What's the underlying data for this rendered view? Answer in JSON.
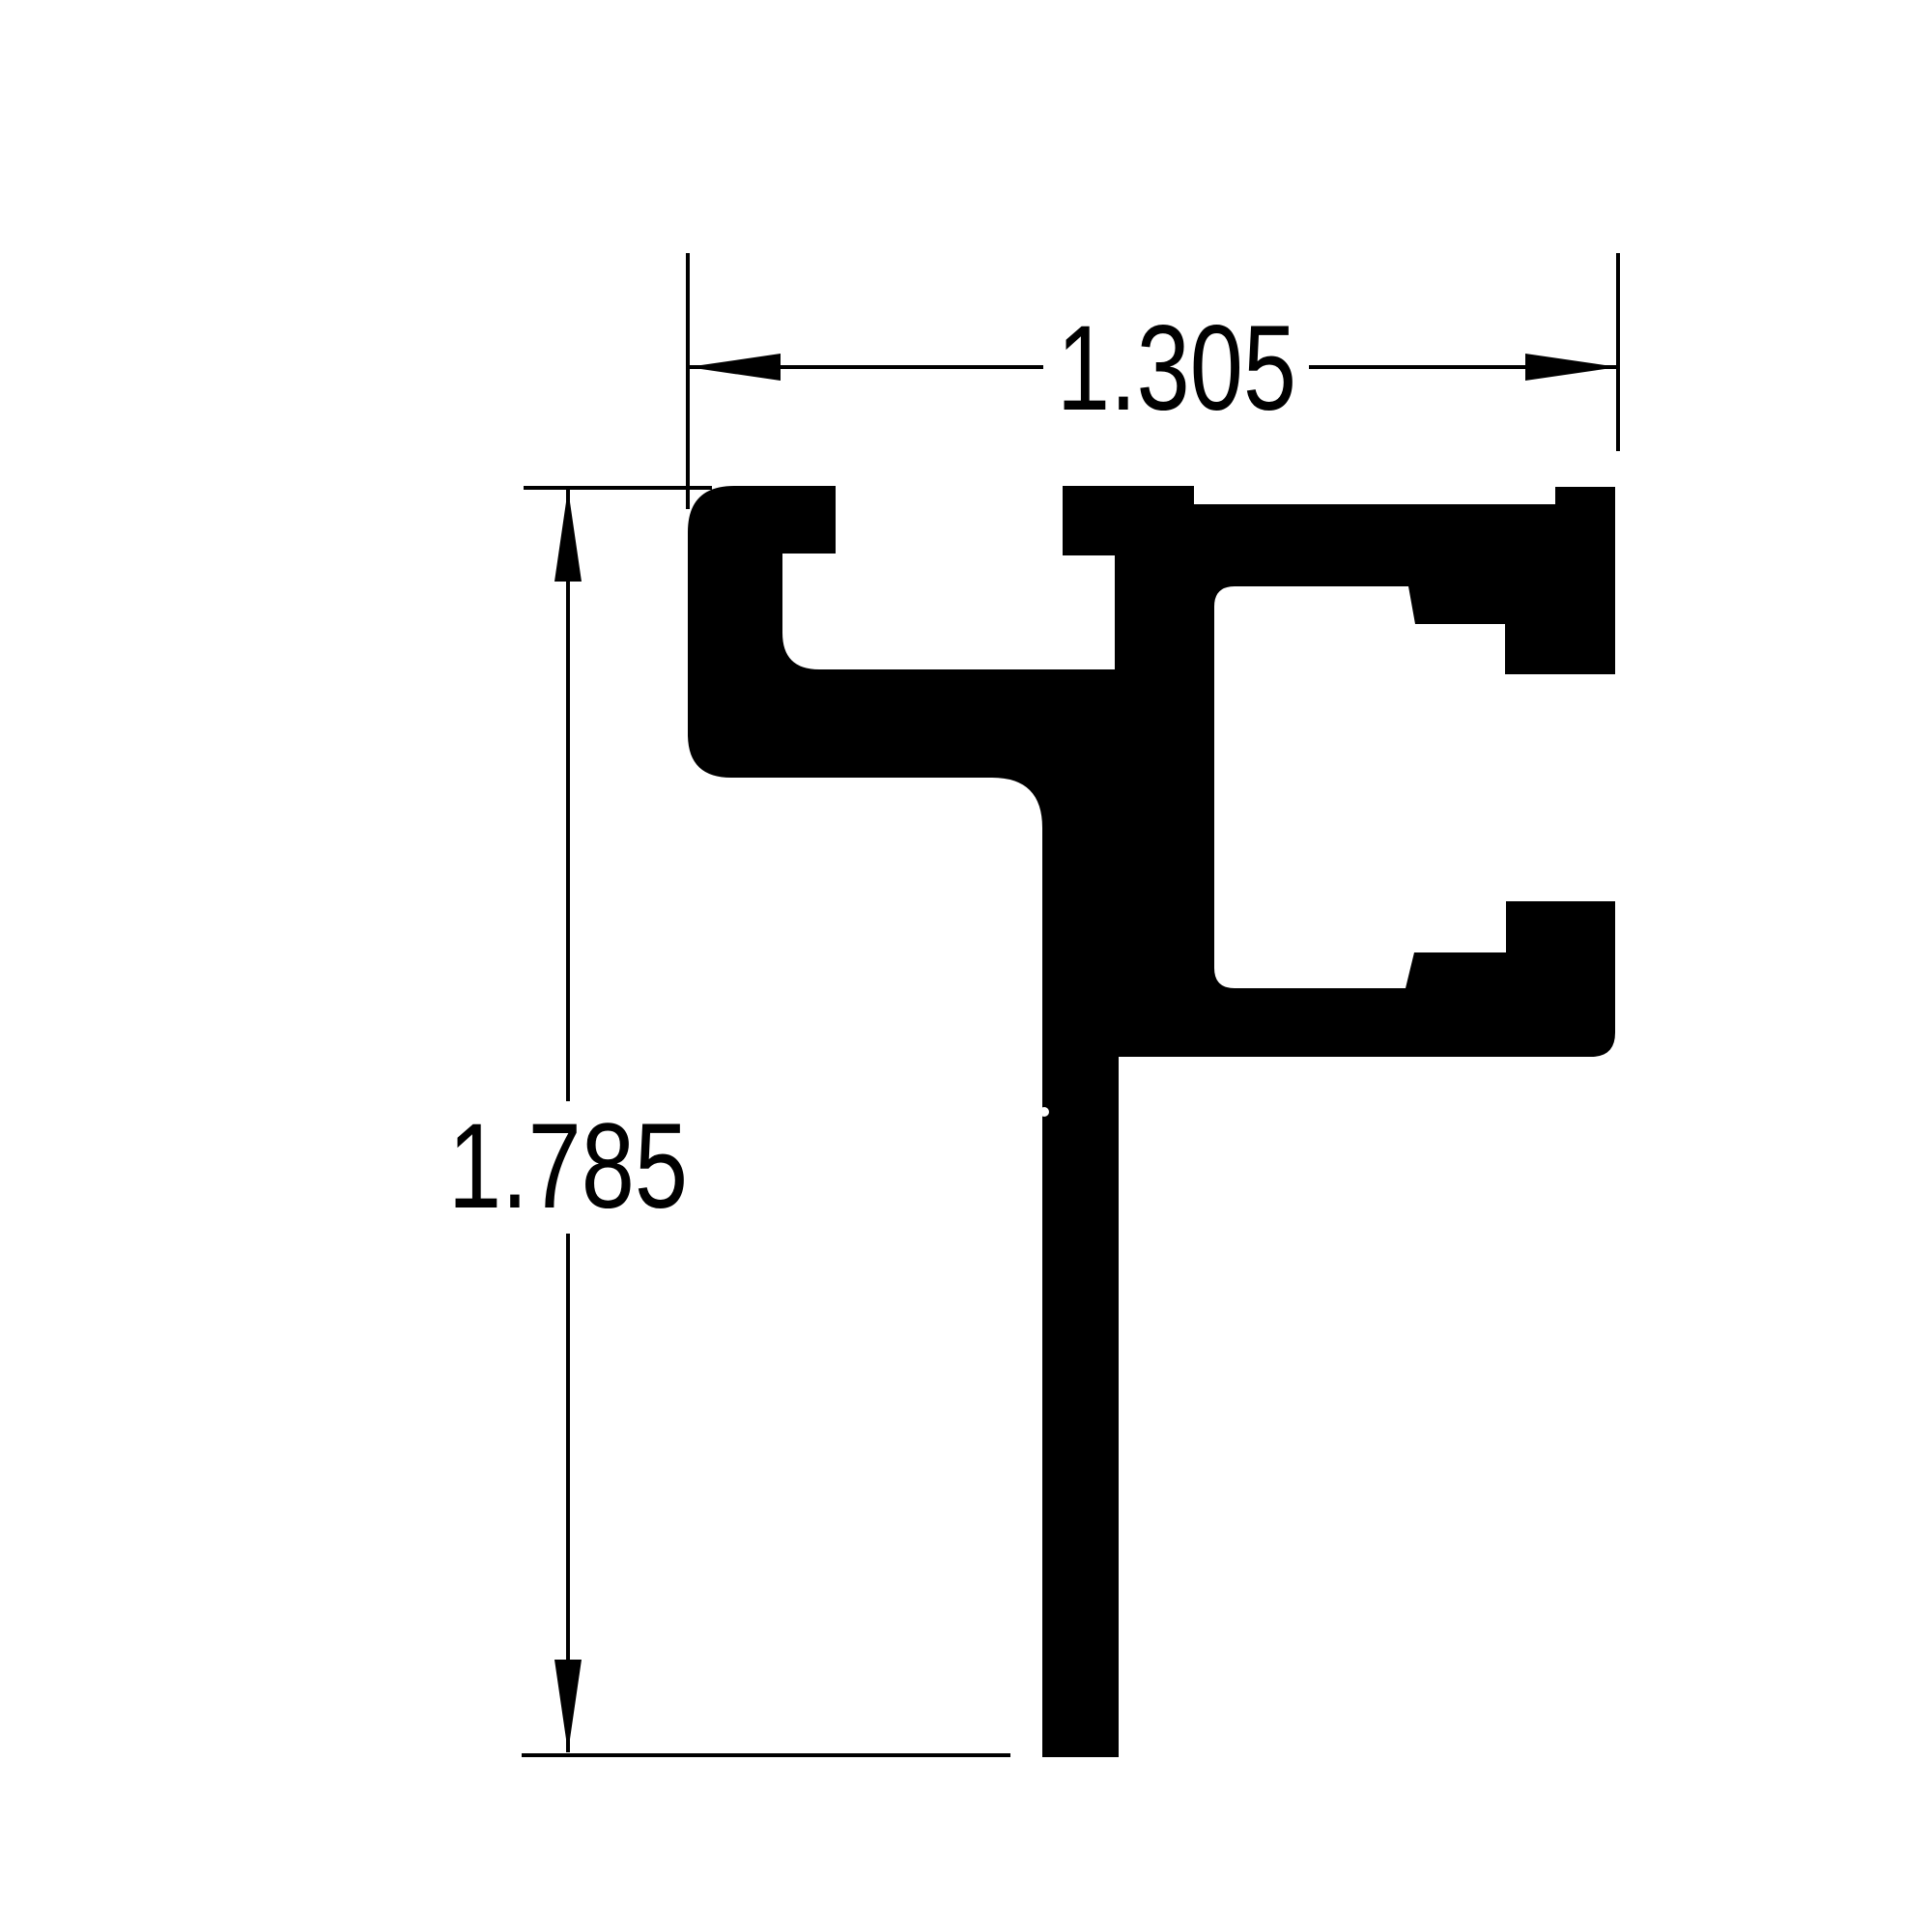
{
  "drawing": {
    "title": "Aluminum extrusion profile cross-section",
    "view": "2D section view with linear dimensions"
  },
  "dimensions": {
    "width": {
      "label": "1.305",
      "orientation": "horizontal"
    },
    "height": {
      "label": "1.785",
      "orientation": "vertical"
    }
  },
  "colors": {
    "background": "#ffffff",
    "line": "#000000",
    "profile_fill": "#000000"
  }
}
